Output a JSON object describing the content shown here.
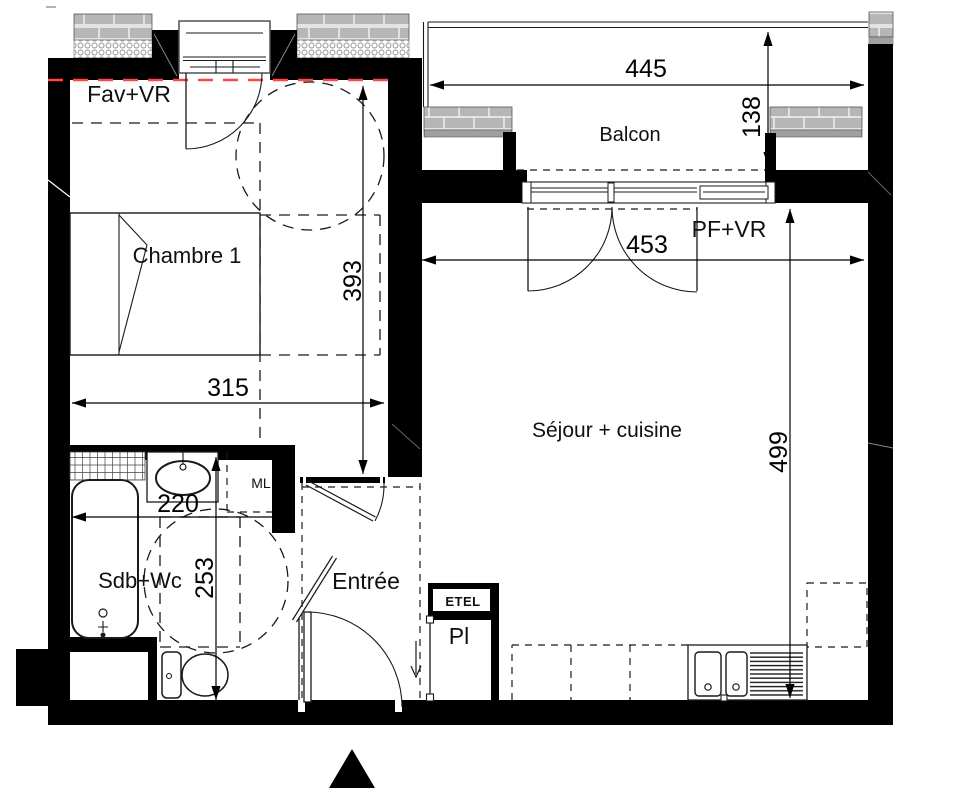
{
  "rooms": {
    "chambre": "Chambre 1",
    "balcon": "Balcon",
    "sejour": "Séjour + cuisine",
    "sdb": "Sdb+Wc",
    "entree": "Entrée",
    "placard": "Pl",
    "etel": "ETEL",
    "ml": "ML"
  },
  "windows": {
    "fav_vr": "Fav+VR",
    "pf_vr": "PF+VR"
  },
  "dimensions": {
    "balcony_width": "445",
    "balcony_depth": "138",
    "sejour_width": "453",
    "chambre_height": "393",
    "chambre_width": "315",
    "sejour_height": "499",
    "sdb_width": "220",
    "sdb_height": "253"
  },
  "icons": {
    "north_arrow": "north-arrow"
  },
  "colors": {
    "wall": "#000000",
    "regulation_line": "#ff4545",
    "masonry": "#b6b6b6",
    "text": "#101010"
  }
}
